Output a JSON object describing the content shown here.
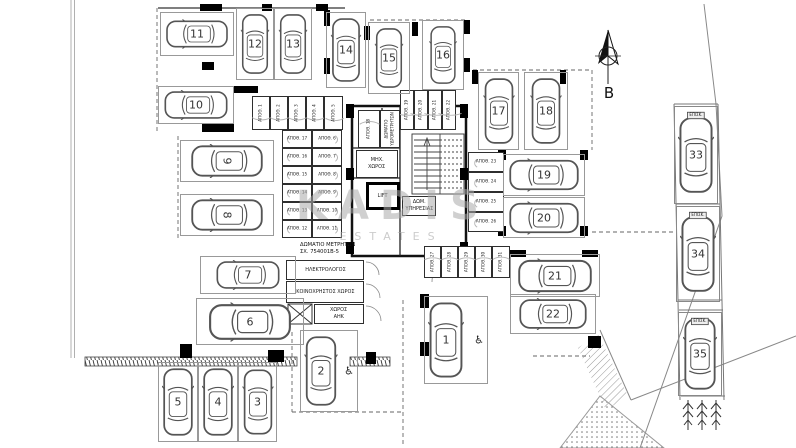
{
  "watermark": {
    "line1": "KADIS",
    "line2": "ESTATES"
  },
  "north": {
    "label": "B"
  },
  "icons": {
    "wheelchair": "♿"
  },
  "parking_spaces": [
    {
      "number": "1",
      "x": 424,
      "y": 296,
      "w": 64,
      "h": 88,
      "orient": "v",
      "accessible": true,
      "car_dx": -10
    },
    {
      "number": "2",
      "x": 300,
      "y": 330,
      "w": 58,
      "h": 82,
      "orient": "v",
      "accessible": true,
      "car_dx": -8
    },
    {
      "number": "3",
      "x": 238,
      "y": 362,
      "w": 39,
      "h": 80,
      "orient": "v"
    },
    {
      "number": "4",
      "x": 198,
      "y": 362,
      "w": 40,
      "h": 80,
      "orient": "v"
    },
    {
      "number": "5",
      "x": 158,
      "y": 362,
      "w": 40,
      "h": 80,
      "orient": "v"
    },
    {
      "number": "6",
      "x": 196,
      "y": 298,
      "w": 108,
      "h": 47,
      "orient": "h"
    },
    {
      "number": "7",
      "x": 200,
      "y": 256,
      "w": 96,
      "h": 38,
      "orient": "h"
    },
    {
      "number": "8",
      "x": 180,
      "y": 194,
      "w": 94,
      "h": 42,
      "orient": "h",
      "num_rot": 90
    },
    {
      "number": "9",
      "x": 180,
      "y": 140,
      "w": 94,
      "h": 42,
      "orient": "h",
      "num_rot": 90
    },
    {
      "number": "10",
      "x": 158,
      "y": 86,
      "w": 76,
      "h": 38,
      "orient": "h"
    },
    {
      "number": "11",
      "x": 160,
      "y": 12,
      "w": 74,
      "h": 44,
      "orient": "h"
    },
    {
      "number": "12",
      "x": 236,
      "y": 8,
      "w": 38,
      "h": 72,
      "orient": "v"
    },
    {
      "number": "13",
      "x": 274,
      "y": 8,
      "w": 38,
      "h": 72,
      "orient": "v"
    },
    {
      "number": "14",
      "x": 326,
      "y": 12,
      "w": 40,
      "h": 76,
      "orient": "v"
    },
    {
      "number": "15",
      "x": 368,
      "y": 22,
      "w": 42,
      "h": 72,
      "orient": "v"
    },
    {
      "number": "16",
      "x": 422,
      "y": 20,
      "w": 42,
      "h": 70,
      "orient": "v"
    },
    {
      "number": "17",
      "x": 478,
      "y": 72,
      "w": 41,
      "h": 78,
      "orient": "v"
    },
    {
      "number": "18",
      "x": 524,
      "y": 72,
      "w": 44,
      "h": 78,
      "orient": "v"
    },
    {
      "number": "19",
      "x": 503,
      "y": 154,
      "w": 82,
      "h": 42,
      "orient": "h"
    },
    {
      "number": "20",
      "x": 503,
      "y": 197,
      "w": 82,
      "h": 41,
      "orient": "h"
    },
    {
      "number": "21",
      "x": 510,
      "y": 254,
      "w": 90,
      "h": 43,
      "orient": "h"
    },
    {
      "number": "22",
      "x": 510,
      "y": 294,
      "w": 86,
      "h": 40,
      "orient": "h"
    },
    {
      "number": "33",
      "x": 674,
      "y": 106,
      "w": 44,
      "h": 98,
      "orient": "v",
      "visitor": true,
      "tag": "ΕΠΙΣΚ."
    },
    {
      "number": "34",
      "x": 676,
      "y": 206,
      "w": 44,
      "h": 96,
      "orient": "v",
      "visitor": true,
      "tag": "ΕΠΙΣΚ."
    },
    {
      "number": "35",
      "x": 678,
      "y": 312,
      "w": 44,
      "h": 84,
      "orient": "v",
      "visitor": true,
      "tag": "ΕΠΙΣΚ."
    }
  ],
  "storages": [
    {
      "label": "ΑΠΟΘ. 1",
      "x": 252,
      "y": 96,
      "w": 18,
      "h": 34,
      "vert": true,
      "door": "b"
    },
    {
      "label": "ΑΠΟΘ. 2",
      "x": 270,
      "y": 96,
      "w": 18,
      "h": 34,
      "vert": true,
      "door": "b"
    },
    {
      "label": "ΑΠΟΘ. 3",
      "x": 288,
      "y": 96,
      "w": 18,
      "h": 34,
      "vert": true,
      "door": "b"
    },
    {
      "label": "ΑΠΟΘ. 4",
      "x": 306,
      "y": 96,
      "w": 18,
      "h": 34,
      "vert": true,
      "door": "b"
    },
    {
      "label": "ΑΠΟΘ. 5",
      "x": 324,
      "y": 96,
      "w": 19,
      "h": 34,
      "vert": true,
      "door": "b"
    },
    {
      "label": "ΑΠΟΘ. 17",
      "x": 282,
      "y": 130,
      "w": 30,
      "h": 18,
      "door": "l"
    },
    {
      "label": "ΑΠΟΘ. 6",
      "x": 312,
      "y": 130,
      "w": 30,
      "h": 18,
      "door": "r"
    },
    {
      "label": "ΑΠΟΘ. 16",
      "x": 282,
      "y": 148,
      "w": 30,
      "h": 18,
      "door": "l"
    },
    {
      "label": "ΑΠΟΘ. 7",
      "x": 312,
      "y": 148,
      "w": 30,
      "h": 18,
      "door": "r"
    },
    {
      "label": "ΑΠΟΘ. 15",
      "x": 282,
      "y": 166,
      "w": 30,
      "h": 18,
      "door": "l"
    },
    {
      "label": "ΑΠΟΘ. 8",
      "x": 312,
      "y": 166,
      "w": 30,
      "h": 18,
      "door": "r"
    },
    {
      "label": "ΑΠΟΘ. 14",
      "x": 282,
      "y": 184,
      "w": 30,
      "h": 18,
      "door": "l"
    },
    {
      "label": "ΑΠΟΘ. 9",
      "x": 312,
      "y": 184,
      "w": 30,
      "h": 18,
      "door": "r"
    },
    {
      "label": "ΑΠΟΘ. 13",
      "x": 282,
      "y": 202,
      "w": 30,
      "h": 18,
      "door": "l"
    },
    {
      "label": "ΑΠΟΘ. 10",
      "x": 312,
      "y": 202,
      "w": 30,
      "h": 18,
      "door": "r"
    },
    {
      "label": "ΑΠΟΘ. 12",
      "x": 282,
      "y": 220,
      "w": 30,
      "h": 18,
      "door": "l"
    },
    {
      "label": "ΑΠΟΘ. 11",
      "x": 312,
      "y": 220,
      "w": 30,
      "h": 18,
      "door": "r"
    },
    {
      "label": "ΑΠΟΘ. 18",
      "x": 358,
      "y": 110,
      "w": 22,
      "h": 38,
      "vert": true,
      "door": "t"
    },
    {
      "label": "ΑΠΟΘ. 19",
      "x": 400,
      "y": 90,
      "w": 14,
      "h": 40,
      "vert": true,
      "door": "b"
    },
    {
      "label": "ΑΠΟΘ. 20",
      "x": 414,
      "y": 90,
      "w": 14,
      "h": 40,
      "vert": true,
      "door": "b"
    },
    {
      "label": "ΑΠΟΘ. 21",
      "x": 428,
      "y": 90,
      "w": 14,
      "h": 40,
      "vert": true,
      "door": "b"
    },
    {
      "label": "ΑΠΟΘ. 22",
      "x": 442,
      "y": 90,
      "w": 14,
      "h": 40,
      "vert": true,
      "door": "b"
    },
    {
      "label": "ΑΠΟΘ. 23",
      "x": 468,
      "y": 152,
      "w": 36,
      "h": 20,
      "door": "l"
    },
    {
      "label": "ΑΠΟΘ. 24",
      "x": 468,
      "y": 172,
      "w": 36,
      "h": 20,
      "door": "l"
    },
    {
      "label": "ΑΠΟΘ. 25",
      "x": 468,
      "y": 192,
      "w": 36,
      "h": 20,
      "door": "l"
    },
    {
      "label": "ΑΠΟΘ. 26",
      "x": 468,
      "y": 212,
      "w": 36,
      "h": 20,
      "door": "l"
    },
    {
      "label": "ΑΠΟΘ. 27",
      "x": 424,
      "y": 246,
      "w": 17,
      "h": 32,
      "vert": true,
      "door": "t"
    },
    {
      "label": "ΑΠΟΘ. 28",
      "x": 441,
      "y": 246,
      "w": 17,
      "h": 32,
      "vert": true,
      "door": "t"
    },
    {
      "label": "ΑΠΟΘ. 29",
      "x": 458,
      "y": 246,
      "w": 17,
      "h": 32,
      "vert": true,
      "door": "t"
    },
    {
      "label": "ΑΠΟΘ. 30",
      "x": 475,
      "y": 246,
      "w": 17,
      "h": 32,
      "vert": true,
      "door": "t"
    },
    {
      "label": "ΑΠΟΘ. 31",
      "x": 492,
      "y": 246,
      "w": 18,
      "h": 32,
      "vert": true,
      "door": "t"
    }
  ],
  "rooms": [
    {
      "name": "water-meter-room",
      "lines": [
        "ΔΩΜΑΤΙΟ",
        "ΥΔΡΟΜΕΤΡΗΤΩΝ"
      ],
      "x": 380,
      "y": 110,
      "w": 20,
      "h": 38,
      "vert": true
    },
    {
      "name": "mechanical-room",
      "lines": [
        "ΜΗΧ.",
        "ΧΩΡΟΣ"
      ],
      "x": 356,
      "y": 150,
      "w": 42,
      "h": 28
    },
    {
      "name": "lift",
      "lines": [
        "LIFT"
      ],
      "x": 366,
      "y": 182,
      "w": 34,
      "h": 28,
      "thick": true
    },
    {
      "name": "service-room",
      "lines": [
        "ΔΩΜ.",
        "ΥΠΗΡΕΣΙΑΣ"
      ],
      "x": 402,
      "y": 196,
      "w": 34,
      "h": 20
    },
    {
      "name": "electrician-room",
      "lines": [
        "ΗΛΕΚΤΡΟΛΟΓΟΣ"
      ],
      "x": 286,
      "y": 260,
      "w": 78,
      "h": 20
    },
    {
      "name": "common-area",
      "lines": [
        "ΚΟΙΝΟΧΡΗΣΤΟΣ ΧΩΡΟΣ"
      ],
      "x": 286,
      "y": 281,
      "w": 78,
      "h": 22
    },
    {
      "name": "eac-room",
      "lines": [
        "ΧΩΡΟΣ",
        "ΑΗΚ"
      ],
      "x": 314,
      "y": 304,
      "w": 50,
      "h": 20
    }
  ],
  "annotations": [
    {
      "name": "meter-room-note",
      "lines": [
        "ΔΩΜΑΤΙΟ ΜΕΤΡΗΤΩΝ",
        "ΣΧ. 754001Β-5"
      ],
      "x": 300,
      "y": 242
    }
  ]
}
